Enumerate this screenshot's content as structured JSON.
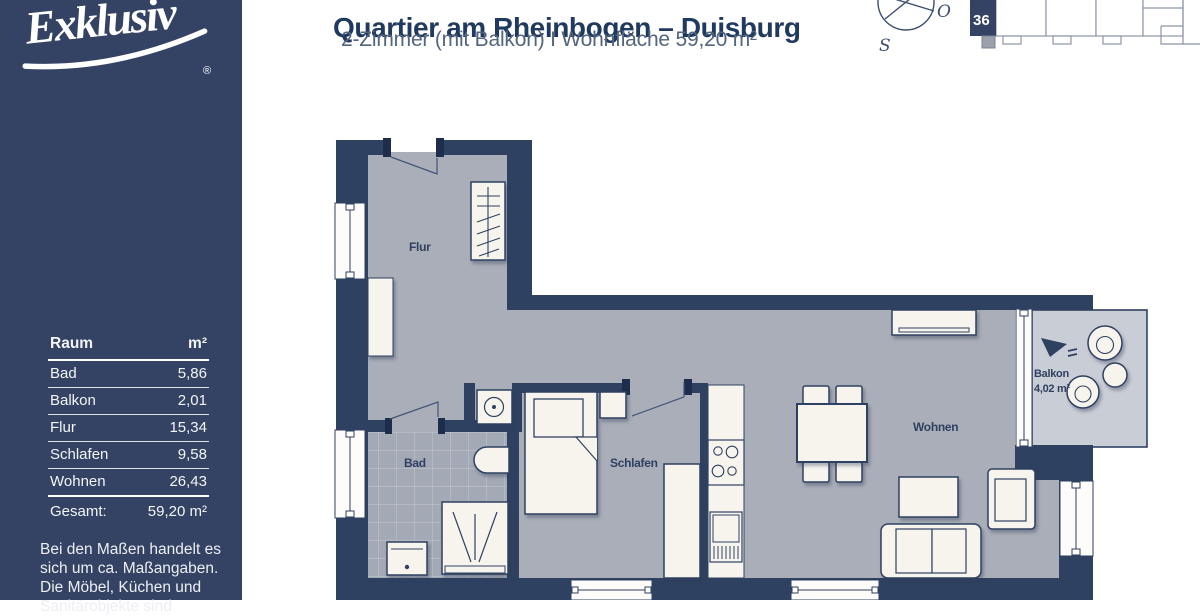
{
  "sidebar": {
    "logo_text": "Exklusiv",
    "logo_reg": "®",
    "table": {
      "header": {
        "room": "Raum",
        "area": "m²"
      },
      "rows": [
        {
          "room": "Bad",
          "area": "5,86"
        },
        {
          "room": "Balkon",
          "area": "2,01"
        },
        {
          "room": "Flur",
          "area": "15,34"
        },
        {
          "room": "Schlafen",
          "area": "9,58"
        },
        {
          "room": "Wohnen",
          "area": "26,43"
        }
      ],
      "total": {
        "label": "Gesamt:",
        "value": "59,20 m²"
      }
    },
    "disclaimer_lines": [
      "Bei den Maßen handelt es",
      "sich um ca. Maßangaben.",
      "Die Möbel, Küchen und",
      "Sanitärobjekte sind"
    ]
  },
  "header": {
    "title": "Quartier am Rheinbogen – Duisburg",
    "subtitle": "2-Zimmer (mit Balkon)  I  Wohnfläche 59,20 m²"
  },
  "compass": {
    "east": "O",
    "south": "S"
  },
  "site_plan": {
    "unit_number": "36"
  },
  "floor_plan": {
    "labels": {
      "flur": "Flur",
      "bad": "Bad",
      "schlafen": "Schlafen",
      "wohnen": "Wohnen",
      "balkon": "Balkon",
      "balkon_area": "4,02 m²"
    }
  },
  "colors": {
    "navy": "#344364",
    "wall": "#2f4161",
    "title": "#20395e",
    "subtitle": "#54657e",
    "floor": "#a9aeb8",
    "bath_floor": "#a3a9b5",
    "balcony_floor": "#c9cdd5",
    "furniture": "#f7f4ee",
    "siteplan_stroke": "#8c95a9"
  }
}
